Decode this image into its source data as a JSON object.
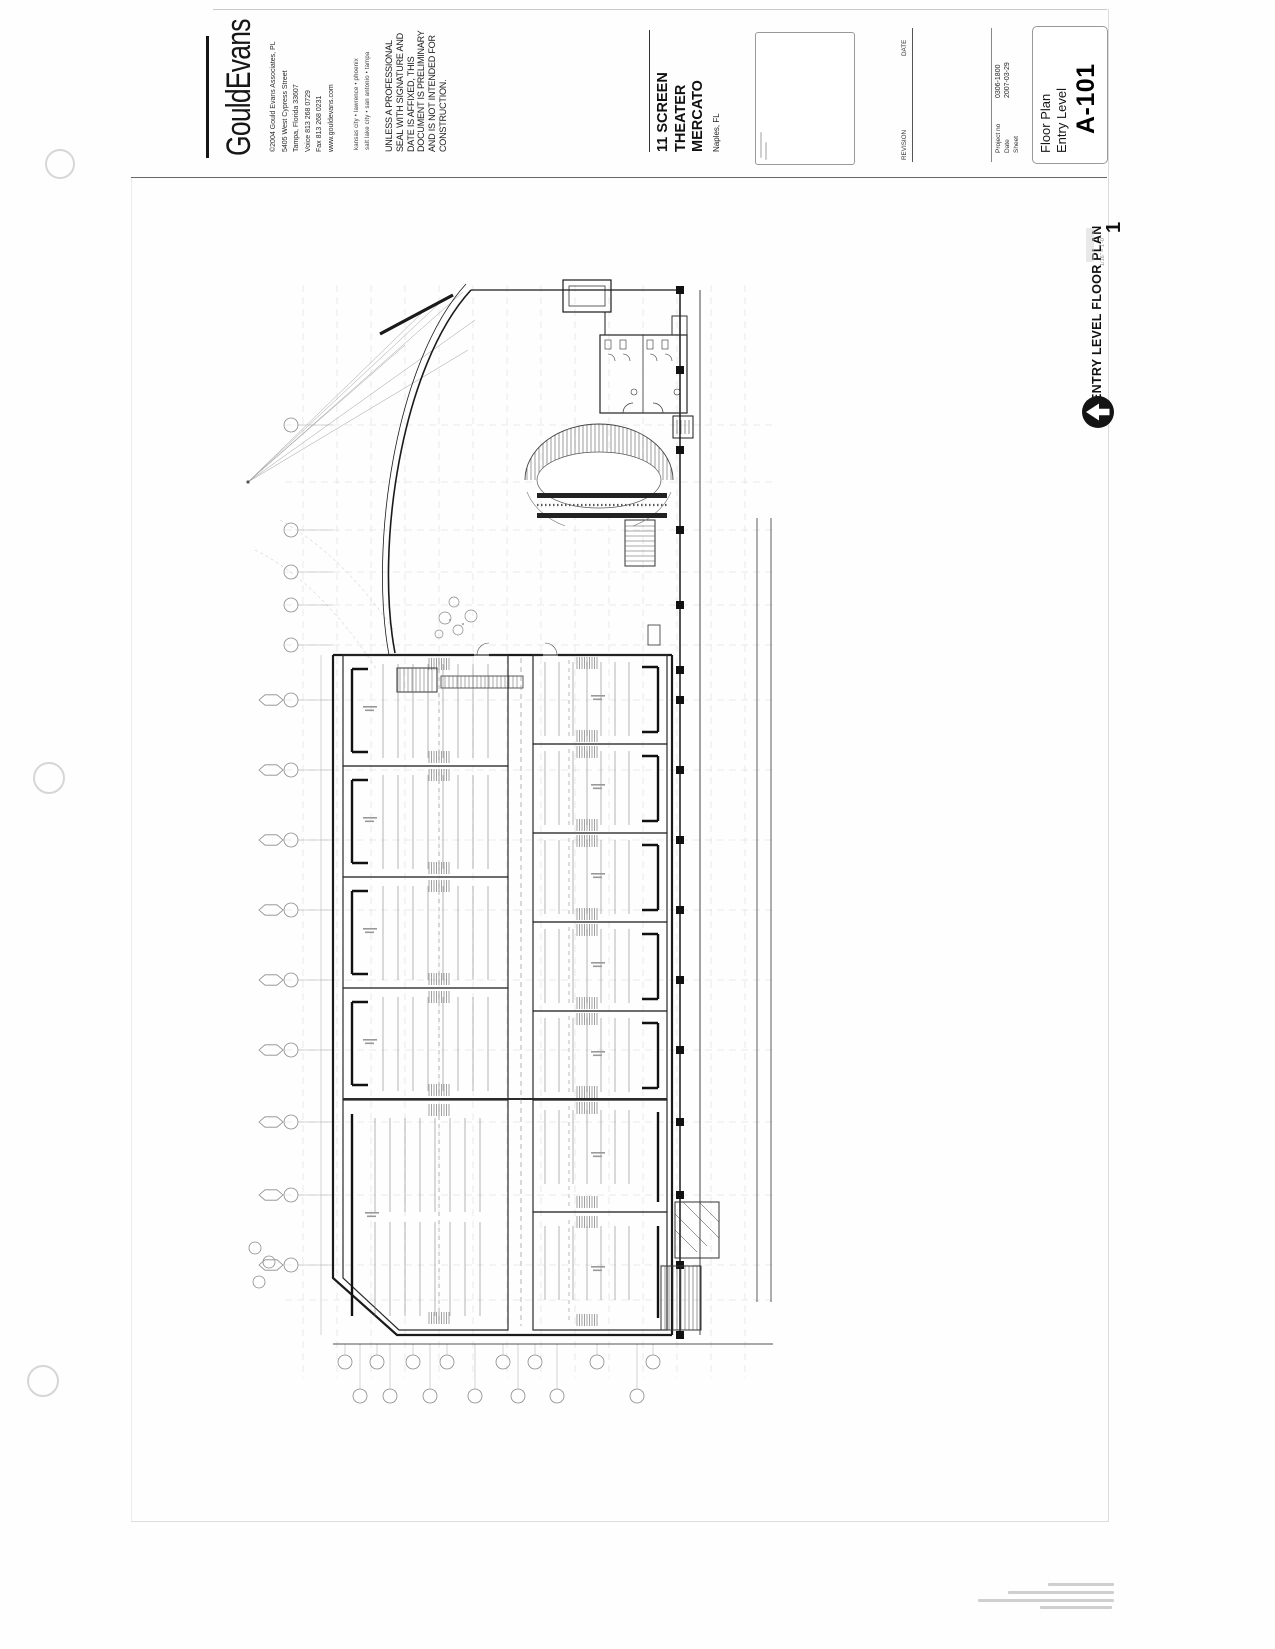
{
  "titleblock": {
    "logo": "GouldEvans",
    "address": [
      "©2004 Gould Evans Associates, PL",
      "5405 West Cypress Street",
      "Tampa, Florida 33607",
      "Voice 813 268 0729",
      "Fax 813 268 0231",
      "www.gouldevans.com"
    ],
    "offices": [
      "kansas city • lawrence • phoenix",
      "salt lake city • san antonio • tampa"
    ],
    "disclaimer": "UNLESS A PROFESSIONAL SEAL WITH SIGNATURE AND DATE IS AFFIXED, THIS DOCUMENT IS PRELIMINARY AND IS NOT INTENDED FOR CONSTRUCTION.",
    "project_title": [
      "11 SCREEN",
      "THEATER",
      "MERCATO"
    ],
    "location": "Naples, FL",
    "revision_header": "REVISION",
    "date_header": "DATE",
    "project_no_label": "Project no",
    "project_no": "0306-1800",
    "date_label": "Date",
    "date_value": "2007-03-29",
    "sheet_label": "Sheet",
    "sheet_name": [
      "Floor Plan",
      "Entry Level"
    ],
    "sheet_number": "A-101"
  },
  "viewport": {
    "number": "1",
    "title": "ENTRY LEVEL FLOOR PLAN",
    "scale": "1/16\" = 1'-0\""
  }
}
